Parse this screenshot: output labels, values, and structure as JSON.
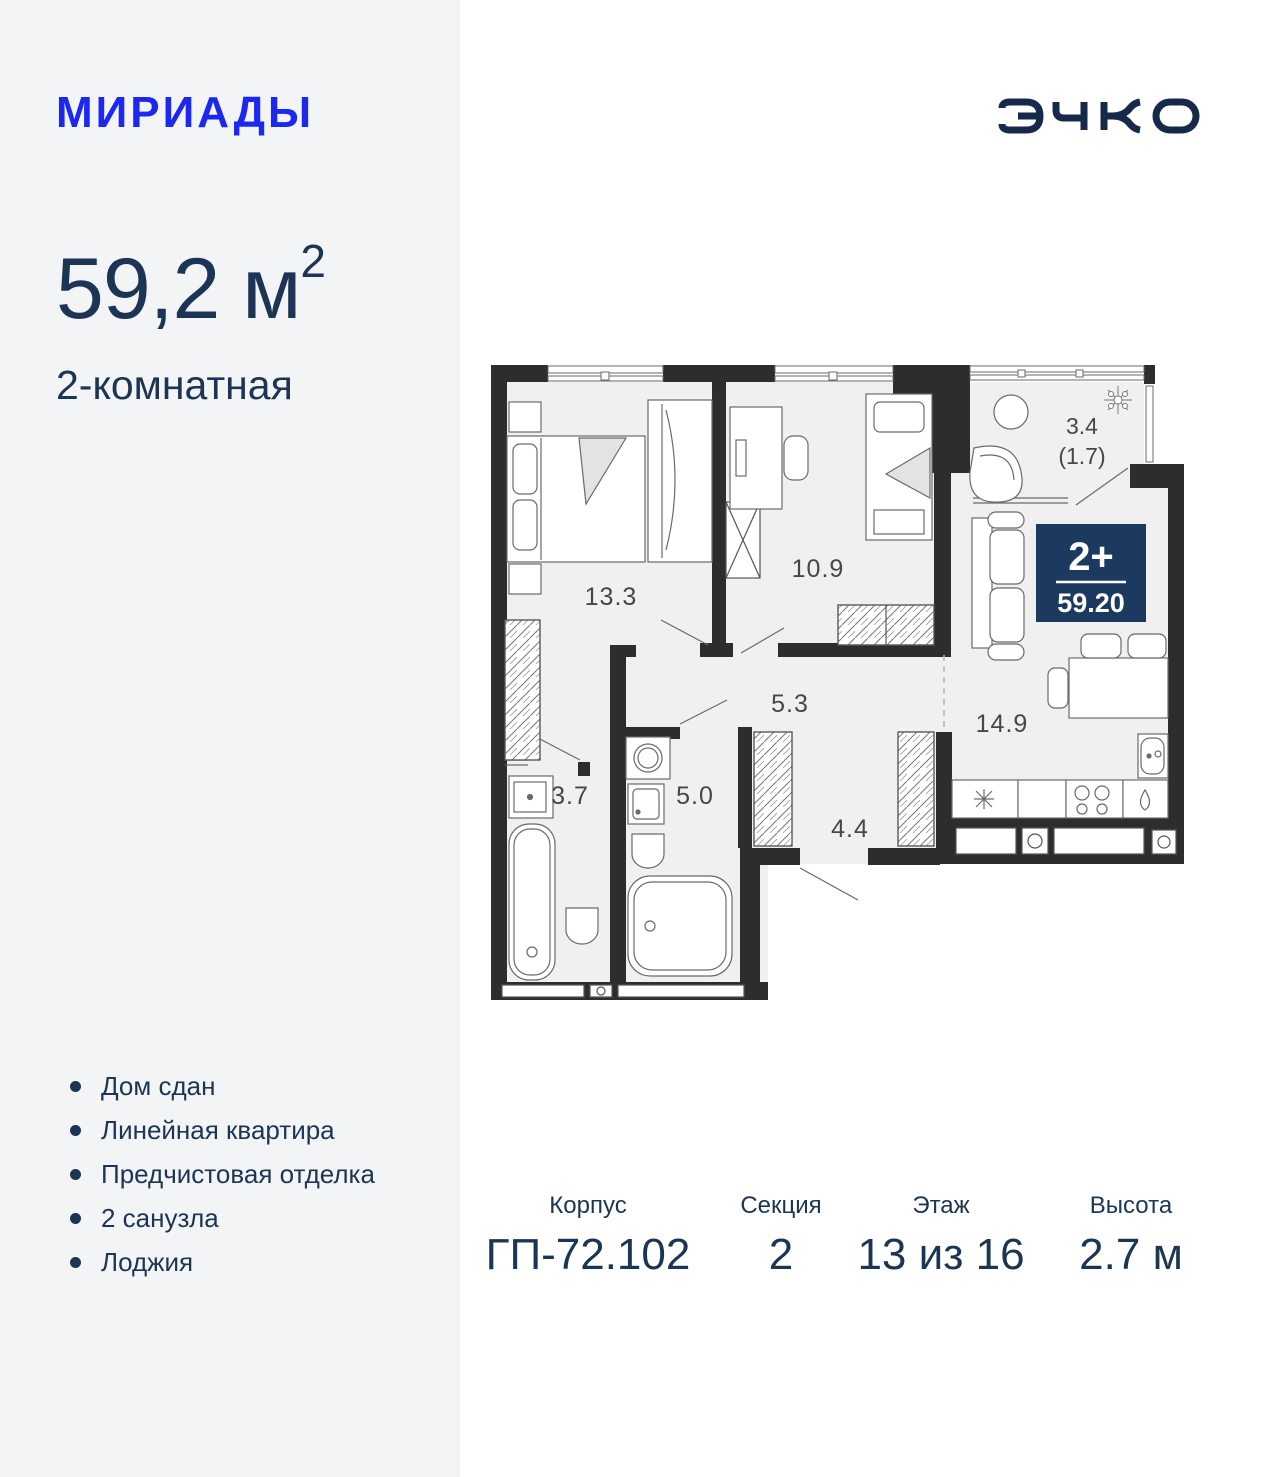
{
  "brand": {
    "name": "МИРИАДЫ",
    "developer": "ЭНКО",
    "accent_color": "#1c27f0",
    "navy_color": "#1d3554"
  },
  "listing": {
    "area_value": "59,2",
    "area_unit": "м",
    "area_superscript": "2",
    "rooms_text": "2-комнатная"
  },
  "badge": {
    "rooms": "2+",
    "area": "59.20",
    "color": "#1c3a5f"
  },
  "plan": {
    "labels": {
      "bedroom": "13.3",
      "room": "10.9",
      "hall": "5.3",
      "bathroom": "3.7",
      "bath": "5.0",
      "corridor": "4.4",
      "kitchen_living": "14.9",
      "balcony": "3.4",
      "balcony_reduced": "(1.7)"
    }
  },
  "features": {
    "items": [
      "Дом сдан",
      "Линейная квартира",
      "Предчистовая отделка",
      "2 санузла",
      "Лоджия"
    ]
  },
  "info": {
    "columns": [
      {
        "label": "Корпус",
        "value": "ГП-72.102"
      },
      {
        "label": "Секция",
        "value": "2"
      },
      {
        "label": "Этаж",
        "value": "13 из 16"
      },
      {
        "label": "Высота",
        "value": "2.7 м"
      }
    ]
  }
}
